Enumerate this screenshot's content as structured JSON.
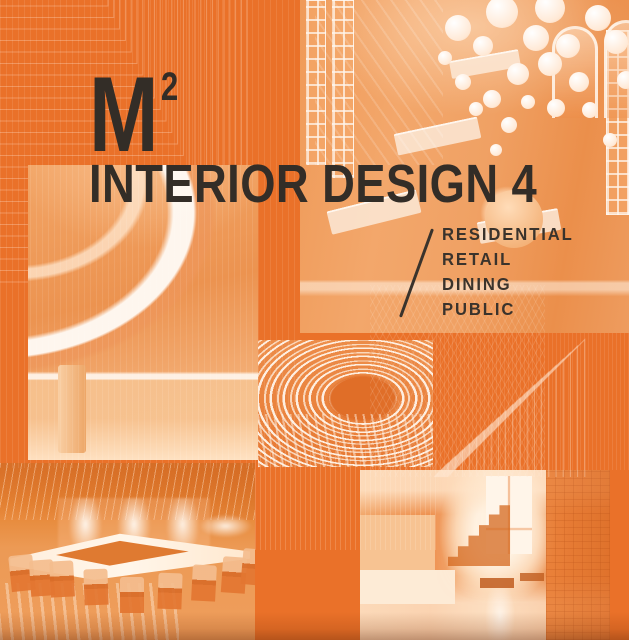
{
  "cover": {
    "series_logo": "M",
    "series_logo_exponent": "2",
    "title": "INTERIOR DESIGN 4",
    "categories": [
      "RESIDENTIAL",
      "RETAIL",
      "DINING",
      "PUBLIC"
    ],
    "colors": {
      "background_orange": "#EA7129",
      "ink": "#332D27",
      "photo_highlight": "#FFE3C4"
    },
    "photos": [
      {
        "name": "retail-store",
        "label": "Retail store interior with spherical pendant lights and arched windows"
      },
      {
        "name": "mall-atrium",
        "label": "Shopping mall atrium with curved white balconies"
      },
      {
        "name": "slatted-tunnel",
        "label": "Curved slatted tunnel corridor"
      },
      {
        "name": "dining-room",
        "label": "Restaurant dining room with large communal table and chairs"
      },
      {
        "name": "residential-hall",
        "label": "Residential hallway with staircase and bright window"
      }
    ]
  }
}
